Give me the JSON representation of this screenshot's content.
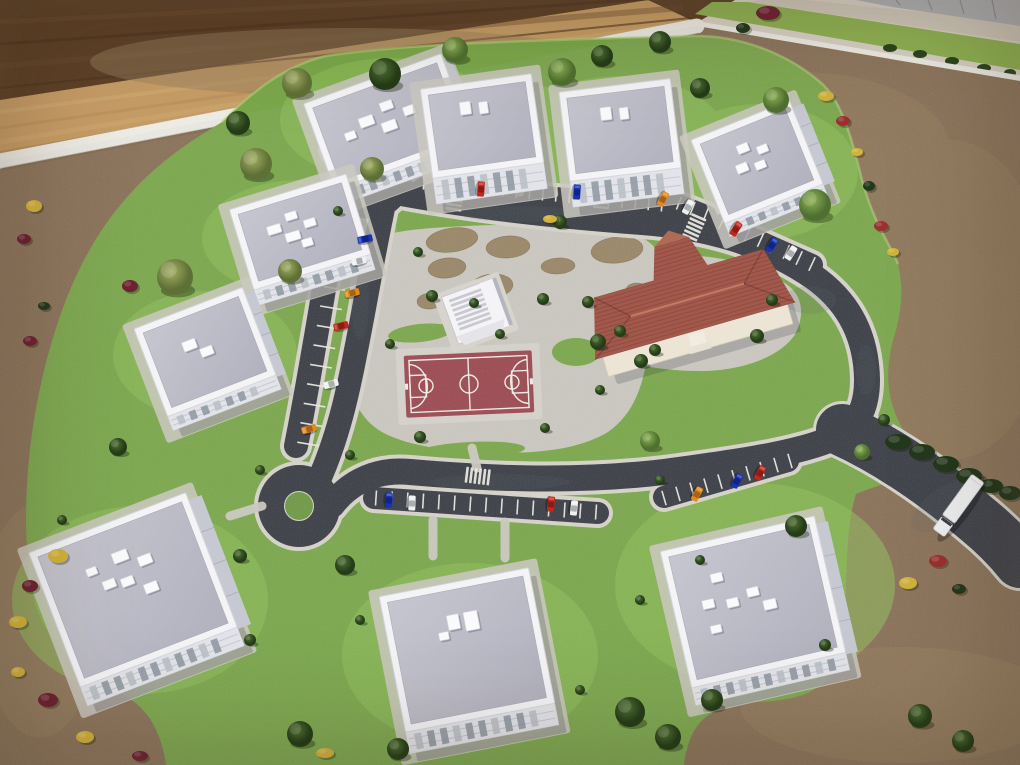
{
  "meta": {
    "description": "Aerial photograph of an architectural scale model of a residential neighborhood: nine white flat-roofed apartment buildings around a loop road with parking bays and two cul-de-sacs, a terracotta hip-roofed community building, a central park with gravel beds, a red basketball court, a white stepped pavilion, model trees, parked toy cars and a white truck, all on a board sitting on a wooden table.",
    "counts": {
      "apartment_buildings": 9,
      "community_buildings": 1,
      "parked_cars": 20,
      "trucks": 1,
      "basketball_courts": 1,
      "cul_de_sacs": 2,
      "crosswalks": 4
    }
  },
  "palette": {
    "wood_dark": "#5d4128",
    "wood_light": "#c69d66",
    "board_edge": "#edece5",
    "dirt": "#8a7157",
    "dirt_light": "#97805f",
    "grass": "#7ba84b",
    "grass_light": "#8fc05a",
    "grass_bright": "#b7d67c",
    "asphalt": "#3a3d45",
    "curb": "#d8d5cb",
    "pavement": "#ccc9c1",
    "gravel_bed": "#9b8767",
    "roof_gray_1": "#c6c6d0",
    "roof_gray_2": "#b2b2bf",
    "building_white": "#f4f4f7",
    "facade": "#e3e4e9",
    "community_roof": "#a2584a",
    "community_wall": "#ece4d4",
    "court_surface": "#9c4850",
    "court_line": "#f2f0ea",
    "marking_white": "#eceae2",
    "tree_green_1": "#8fb457",
    "tree_green_2": "#4e7030",
    "tree_dark_1": "#507134",
    "tree_dark_2": "#243c18",
    "tree_olive_1": "#a3af63",
    "tree_olive_2": "#5f7036",
    "hedge": "#24381c",
    "shrub_yellow": "#d2b23c",
    "shrub_maroon": "#6e2233",
    "shrub_red": "#9c3030",
    "car_red": "#c1271b",
    "car_blue": "#1633b8",
    "car_orange": "#e3891f",
    "car_white": "#eef0f2",
    "truck_white": "#eff0f2"
  },
  "scene": {
    "apartment_buildings": [
      {
        "id": 1,
        "cx": 388,
        "cy": 122,
        "w": 146,
        "h": 92,
        "rot": -20,
        "f": 16,
        "fr": 8,
        "boxes": [
          [
            -20,
            -8,
            15,
            10
          ],
          [
            4,
            -16,
            13,
            9
          ],
          [
            0,
            4,
            15,
            10
          ],
          [
            24,
            -4,
            12,
            9
          ],
          [
            -40,
            0,
            11,
            8
          ]
        ]
      },
      {
        "id": 2,
        "cx": 300,
        "cy": 232,
        "w": 122,
        "h": 84,
        "rot": -17,
        "f": 16,
        "fr": 0,
        "boxes": [
          [
            -24,
            -10,
            14,
            9
          ],
          [
            -4,
            -18,
            12,
            8
          ],
          [
            -8,
            2,
            15,
            9
          ],
          [
            12,
            -6,
            12,
            8
          ],
          [
            4,
            12,
            11,
            8
          ]
        ]
      },
      {
        "id": 3,
        "cx": 205,
        "cy": 352,
        "w": 116,
        "h": 94,
        "rot": -21,
        "f": 15,
        "fr": 10,
        "boxes": [
          [
            -12,
            -12,
            14,
            10
          ],
          [
            2,
            0,
            13,
            9
          ]
        ]
      },
      {
        "id": 4,
        "cx": 482,
        "cy": 126,
        "w": 112,
        "h": 90,
        "rot": -8,
        "f": 26,
        "fr": 0,
        "boxes": [
          [
            -14,
            -20,
            11,
            13
          ],
          [
            4,
            -18,
            9,
            12
          ]
        ]
      },
      {
        "id": 5,
        "cx": 620,
        "cy": 130,
        "w": 112,
        "h": 90,
        "rot": -7,
        "f": 26,
        "fr": 0,
        "boxes": [
          [
            -12,
            -18,
            11,
            13
          ],
          [
            6,
            -16,
            9,
            12
          ]
        ]
      },
      {
        "id": 6,
        "cx": 757,
        "cy": 162,
        "w": 106,
        "h": 90,
        "rot": -22,
        "f": 14,
        "fr": 12,
        "boxes": [
          [
            -8,
            -18,
            12,
            9
          ],
          [
            10,
            -10,
            11,
            8
          ],
          [
            -16,
            0,
            12,
            9
          ],
          [
            2,
            4,
            11,
            8
          ]
        ]
      },
      {
        "id": 7,
        "cx": 133,
        "cy": 590,
        "w": 168,
        "h": 144,
        "rot": -21,
        "f": 20,
        "fr": 14,
        "boxes": [
          [
            0,
            -36,
            16,
            11
          ],
          [
            22,
            -24,
            14,
            10
          ],
          [
            -20,
            -14,
            13,
            9
          ],
          [
            -2,
            -10,
            13,
            9
          ],
          [
            18,
            4,
            14,
            10
          ],
          [
            -32,
            -32,
            11,
            8
          ]
        ]
      },
      {
        "id": 8,
        "cx": 467,
        "cy": 650,
        "w": 152,
        "h": 138,
        "rot": -11,
        "f": 22,
        "fr": 0,
        "boxes": [
          [
            -8,
            -30,
            12,
            15
          ],
          [
            10,
            -28,
            14,
            19
          ],
          [
            -20,
            -18,
            10,
            8
          ]
        ]
      },
      {
        "id": 9,
        "cx": 753,
        "cy": 602,
        "w": 158,
        "h": 140,
        "rot": -13,
        "f": 18,
        "fr": 12,
        "boxes": [
          [
            -30,
            -32,
            12,
            9
          ],
          [
            -44,
            -8,
            12,
            9
          ],
          [
            -20,
            -4,
            12,
            9
          ],
          [
            2,
            -10,
            12,
            9
          ],
          [
            16,
            6,
            13,
            10
          ],
          [
            -42,
            18,
            11,
            8
          ]
        ]
      }
    ],
    "trees": [
      [
        297,
        83,
        15,
        "o"
      ],
      [
        385,
        74,
        16,
        "d"
      ],
      [
        455,
        50,
        13,
        "g"
      ],
      [
        562,
        72,
        14,
        "g"
      ],
      [
        602,
        56,
        11,
        "d"
      ],
      [
        660,
        42,
        11,
        "d"
      ],
      [
        700,
        88,
        10,
        "d"
      ],
      [
        776,
        100,
        13,
        "g"
      ],
      [
        815,
        205,
        16,
        "g"
      ],
      [
        238,
        123,
        12,
        "d"
      ],
      [
        256,
        164,
        16,
        "o"
      ],
      [
        175,
        277,
        18,
        "o"
      ],
      [
        290,
        271,
        12,
        "o"
      ],
      [
        118,
        447,
        9,
        "d"
      ],
      [
        372,
        169,
        12,
        "o"
      ],
      [
        345,
        565,
        10,
        "d"
      ],
      [
        300,
        734,
        13,
        "d"
      ],
      [
        398,
        749,
        11,
        "d"
      ],
      [
        630,
        712,
        15,
        "d"
      ],
      [
        668,
        737,
        13,
        "d"
      ],
      [
        920,
        716,
        12,
        "d"
      ],
      [
        963,
        741,
        11,
        "d"
      ],
      [
        796,
        526,
        11,
        "d"
      ],
      [
        650,
        441,
        10,
        "g"
      ],
      [
        862,
        452,
        8,
        "g"
      ],
      [
        432,
        296,
        6,
        "d"
      ],
      [
        474,
        303,
        5,
        "d"
      ],
      [
        543,
        299,
        6,
        "d"
      ],
      [
        500,
        334,
        5,
        "d"
      ],
      [
        620,
        331,
        6,
        "d"
      ],
      [
        560,
        222,
        7,
        "d"
      ],
      [
        655,
        350,
        6,
        "d"
      ],
      [
        600,
        390,
        5,
        "d"
      ],
      [
        420,
        437,
        6,
        "d"
      ],
      [
        390,
        344,
        5,
        "d"
      ],
      [
        545,
        428,
        5,
        "d"
      ],
      [
        598,
        342,
        8,
        "d"
      ],
      [
        641,
        361,
        7,
        "d"
      ],
      [
        757,
        336,
        7,
        "d"
      ],
      [
        772,
        300,
        6,
        "d"
      ],
      [
        588,
        302,
        6,
        "d"
      ],
      [
        240,
        556,
        7,
        "d"
      ],
      [
        338,
        211,
        5,
        "d"
      ],
      [
        418,
        252,
        5,
        "d"
      ],
      [
        660,
        480,
        5,
        "d"
      ],
      [
        350,
        455,
        5,
        "d"
      ],
      [
        260,
        470,
        5,
        "d"
      ],
      [
        884,
        420,
        6,
        "d"
      ],
      [
        700,
        560,
        5,
        "d"
      ],
      [
        825,
        645,
        6,
        "d"
      ],
      [
        640,
        600,
        5,
        "d"
      ],
      [
        250,
        640,
        6,
        "d"
      ],
      [
        62,
        520,
        5,
        "d"
      ],
      [
        580,
        690,
        5,
        "d"
      ],
      [
        360,
        620,
        5,
        "d"
      ],
      [
        712,
        700,
        11,
        "d"
      ]
    ],
    "shrubs": [
      [
        826,
        96,
        8,
        5,
        "y"
      ],
      [
        843,
        121,
        7,
        5,
        "r"
      ],
      [
        857,
        152,
        6,
        4,
        "y"
      ],
      [
        869,
        186,
        6,
        5,
        "h"
      ],
      [
        881,
        226,
        7,
        5,
        "r"
      ],
      [
        893,
        252,
        6,
        4,
        "y"
      ],
      [
        908,
        583,
        9,
        6,
        "y"
      ],
      [
        938,
        561,
        9,
        6,
        "r"
      ],
      [
        959,
        589,
        7,
        5,
        "h"
      ],
      [
        34,
        206,
        8,
        6,
        "y"
      ],
      [
        24,
        239,
        7,
        5,
        "m"
      ],
      [
        130,
        286,
        8,
        6,
        "m"
      ],
      [
        44,
        306,
        6,
        4,
        "h"
      ],
      [
        30,
        341,
        7,
        5,
        "m"
      ],
      [
        58,
        556,
        10,
        7,
        "y"
      ],
      [
        30,
        586,
        8,
        6,
        "m"
      ],
      [
        18,
        622,
        9,
        6,
        "y"
      ],
      [
        48,
        700,
        10,
        7,
        "m"
      ],
      [
        18,
        672,
        7,
        5,
        "y"
      ],
      [
        85,
        737,
        9,
        6,
        "y"
      ],
      [
        325,
        753,
        9,
        5,
        "y"
      ],
      [
        140,
        756,
        8,
        5,
        "m"
      ],
      [
        768,
        13,
        12,
        7,
        "m"
      ],
      [
        743,
        28,
        7,
        5,
        "h"
      ],
      [
        550,
        219,
        7,
        4,
        "y"
      ],
      [
        898,
        442,
        13,
        8,
        "h"
      ],
      [
        922,
        452,
        13,
        8,
        "h"
      ],
      [
        946,
        464,
        13,
        8,
        "h"
      ],
      [
        969,
        476,
        13,
        8,
        "h"
      ],
      [
        991,
        486,
        12,
        7,
        "h"
      ],
      [
        1010,
        493,
        11,
        7,
        "h"
      ]
    ],
    "cars": [
      [
        481,
        189,
        94,
        "red"
      ],
      [
        577,
        192,
        94,
        "blue"
      ],
      [
        663,
        199,
        118,
        "orange"
      ],
      [
        688,
        207,
        118,
        "white"
      ],
      [
        736,
        229,
        122,
        "red"
      ],
      [
        772,
        245,
        122,
        "blue"
      ],
      [
        791,
        253,
        122,
        "white"
      ],
      [
        365,
        239,
        -12,
        "blue"
      ],
      [
        359,
        261,
        -12,
        "white"
      ],
      [
        352,
        293,
        -14,
        "orange"
      ],
      [
        341,
        326,
        -14,
        "red"
      ],
      [
        331,
        384,
        -16,
        "white"
      ],
      [
        309,
        429,
        -16,
        "orange"
      ],
      [
        389,
        500,
        92,
        "blue"
      ],
      [
        412,
        503,
        92,
        "white"
      ],
      [
        551,
        504,
        96,
        "red"
      ],
      [
        574,
        508,
        96,
        "white"
      ],
      [
        697,
        494,
        118,
        "orange"
      ],
      [
        737,
        481,
        118,
        "blue"
      ],
      [
        760,
        473,
        118,
        "red"
      ]
    ],
    "stall_rows": [
      [
        424,
        182,
        662,
        204,
        19,
        15
      ],
      [
        652,
        192,
        706,
        214,
        5,
        14
      ],
      [
        722,
        222,
        812,
        264,
        8,
        15
      ],
      [
        344,
        230,
        308,
        444,
        12,
        22
      ],
      [
        376,
        498,
        596,
        512,
        15,
        15
      ],
      [
        664,
        498,
        790,
        461,
        10,
        15
      ]
    ],
    "crosswalks": [
      [
        455,
        199,
        9
      ],
      [
        602,
        197,
        6
      ],
      [
        694,
        228,
        24
      ],
      [
        477,
        476,
        97
      ]
    ],
    "truck": {
      "x": 958,
      "y": 506,
      "rot": -54
    }
  }
}
